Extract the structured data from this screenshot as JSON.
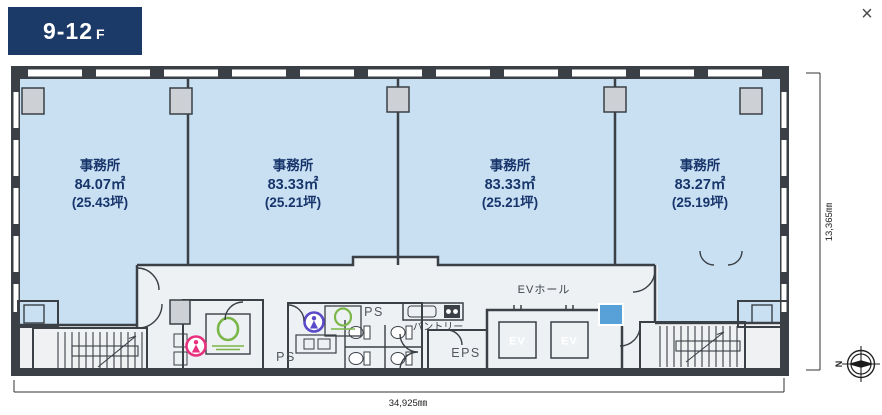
{
  "window": {
    "close_icon": "×"
  },
  "floor_badge": {
    "label": "9-12",
    "suffix": "F"
  },
  "offices": [
    {
      "name": "事務所",
      "area_sqm": "84.07㎡",
      "area_tsubo": "(25.43坪)"
    },
    {
      "name": "事務所",
      "area_sqm": "83.33㎡",
      "area_tsubo": "(25.21坪)"
    },
    {
      "name": "事務所",
      "area_sqm": "83.33㎡",
      "area_tsubo": "(25.21坪)"
    },
    {
      "name": "事務所",
      "area_sqm": "83.27㎡",
      "area_tsubo": "(25.19坪)"
    }
  ],
  "core": {
    "ev_hall_label": "EVホール",
    "ev_label": "EV",
    "eps_label": "EPS",
    "pantry_label": "パントリー",
    "ps_label": "PS"
  },
  "dimensions": {
    "bottom_width": "34,925㎜",
    "right_height": "13,365㎜"
  },
  "compass": {
    "north_label": "N"
  },
  "colors": {
    "badge_navy": "#1c3a68",
    "office_fill": "#c9e0f3",
    "office_text": "#17356b",
    "core_fill": "#eef1f4",
    "ev_fill": "#58a0d8",
    "wall": "#3a4046",
    "womens_fill": "#f9dcea",
    "mens_fill": "#ddecf6",
    "accent_pink": "#e8317e",
    "accent_purple": "#5a49c8",
    "accent_green": "#7ab648"
  }
}
